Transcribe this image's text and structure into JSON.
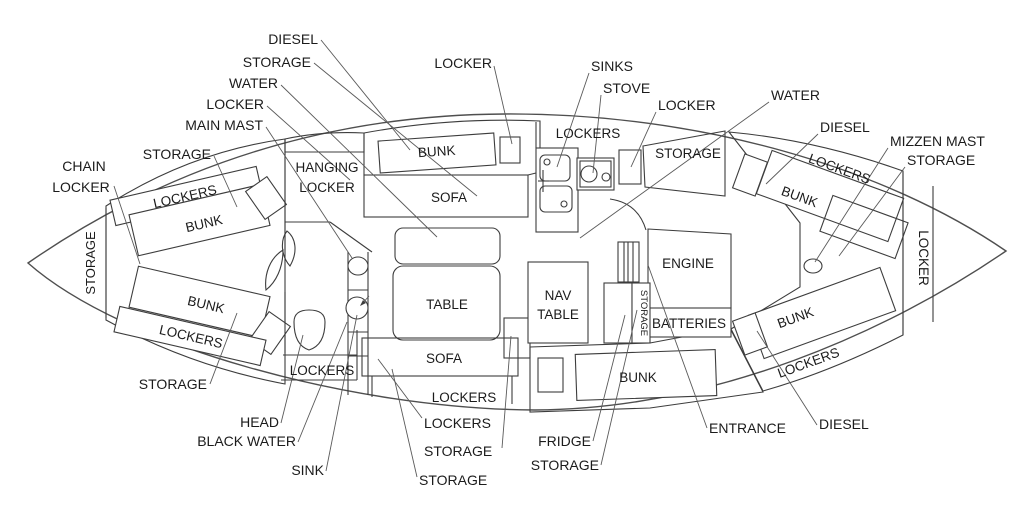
{
  "diagram_type": "sailboat-interior-floor-plan",
  "colors": {
    "background": "#ffffff",
    "wall_line": "#3d3d3d",
    "hull_line": "#4f4f4f",
    "leader_line": "#5a5a5a",
    "hatch_line": "#c4c4c4",
    "crosshatch_line": "#bdbdbd",
    "label_text": "#1b1b1b"
  },
  "external_labels": [
    {
      "id": "label-diesel-port-fwd",
      "anchor": "end",
      "lines": [
        {
          "t": "DIESEL",
          "x": 318,
          "y": 44
        }
      ],
      "leader": [
        [
          321,
          40
        ],
        [
          410,
          150
        ]
      ]
    },
    {
      "id": "label-storage-port-fwd",
      "anchor": "end",
      "lines": [
        {
          "t": "STORAGE",
          "x": 311,
          "y": 67
        }
      ],
      "leader": [
        [
          314,
          63
        ],
        [
          477,
          196
        ]
      ]
    },
    {
      "id": "label-water-port-fwd",
      "anchor": "end",
      "lines": [
        {
          "t": "WATER",
          "x": 278,
          "y": 88
        }
      ],
      "leader": [
        [
          281,
          85
        ],
        [
          437,
          237
        ]
      ]
    },
    {
      "id": "label-locker-port-fwd",
      "anchor": "end",
      "lines": [
        {
          "t": "LOCKER",
          "x": 264,
          "y": 109
        }
      ],
      "leader": [
        [
          267,
          106
        ],
        [
          350,
          180
        ]
      ]
    },
    {
      "id": "label-main-mast",
      "anchor": "end",
      "lines": [
        {
          "t": "MAIN MAST",
          "x": 263,
          "y": 130
        }
      ],
      "leader": [
        [
          266,
          127
        ],
        [
          352,
          258
        ]
      ]
    },
    {
      "id": "label-chain-locker",
      "anchor": "middle",
      "lines": [
        {
          "t": "CHAIN",
          "x": 84,
          "y": 171
        },
        {
          "t": "LOCKER",
          "x": 81,
          "y": 192
        }
      ],
      "leader": [
        [
          114,
          186
        ],
        [
          140,
          264
        ]
      ]
    },
    {
      "id": "label-storage-bow-top",
      "anchor": "end",
      "lines": [
        {
          "t": "STORAGE",
          "x": 211,
          "y": 159
        }
      ],
      "leader": [
        [
          214,
          156
        ],
        [
          237,
          207
        ]
      ]
    },
    {
      "id": "label-locker-top-center",
      "anchor": "end",
      "lines": [
        {
          "t": "LOCKER",
          "x": 492,
          "y": 68
        }
      ],
      "leader": [
        [
          494,
          66
        ],
        [
          512,
          144
        ]
      ]
    },
    {
      "id": "label-sinks",
      "anchor": "start",
      "lines": [
        {
          "t": "SINKS",
          "x": 591,
          "y": 71
        }
      ],
      "leader": [
        [
          589,
          73
        ],
        [
          557,
          167
        ]
      ]
    },
    {
      "id": "label-stove",
      "anchor": "start",
      "lines": [
        {
          "t": "STOVE",
          "x": 603,
          "y": 93
        }
      ],
      "leader": [
        [
          601,
          95
        ],
        [
          593,
          173
        ]
      ]
    },
    {
      "id": "label-locker-galley",
      "anchor": "start",
      "lines": [
        {
          "t": "LOCKER",
          "x": 658,
          "y": 110
        }
      ],
      "leader": [
        [
          656,
          112
        ],
        [
          631,
          167
        ]
      ]
    },
    {
      "id": "label-water-stbd",
      "anchor": "start",
      "lines": [
        {
          "t": "WATER",
          "x": 771,
          "y": 100
        }
      ],
      "leader": [
        [
          769,
          102
        ],
        [
          580,
          238
        ]
      ]
    },
    {
      "id": "label-diesel-aft-port",
      "anchor": "start",
      "lines": [
        {
          "t": "DIESEL",
          "x": 820,
          "y": 132
        }
      ],
      "leader": [
        [
          818,
          134
        ],
        [
          766,
          184
        ]
      ]
    },
    {
      "id": "label-mizzen-mast",
      "anchor": "start",
      "lines": [
        {
          "t": "MIZZEN MAST",
          "x": 890,
          "y": 146
        }
      ],
      "leader": [
        [
          888,
          148
        ],
        [
          815,
          262
        ]
      ]
    },
    {
      "id": "label-storage-stern",
      "anchor": "start",
      "lines": [
        {
          "t": "STORAGE",
          "x": 907,
          "y": 165
        }
      ],
      "leader": [
        [
          905,
          167
        ],
        [
          839,
          256
        ]
      ]
    },
    {
      "id": "label-storage-bow-bottom",
      "anchor": "end",
      "lines": [
        {
          "t": "STORAGE",
          "x": 207,
          "y": 389
        }
      ],
      "leader": [
        [
          210,
          384
        ],
        [
          237,
          313
        ]
      ]
    },
    {
      "id": "label-head",
      "anchor": "end",
      "lines": [
        {
          "t": "HEAD",
          "x": 279,
          "y": 427
        }
      ],
      "leader": [
        [
          281,
          423
        ],
        [
          303,
          335
        ]
      ]
    },
    {
      "id": "label-black-water",
      "anchor": "end",
      "lines": [
        {
          "t": "BLACK WATER",
          "x": 296,
          "y": 446
        }
      ],
      "leader": [
        [
          298,
          442
        ],
        [
          347,
          322
        ]
      ]
    },
    {
      "id": "label-sink",
      "anchor": "end",
      "lines": [
        {
          "t": "SINK",
          "x": 324,
          "y": 475
        }
      ],
      "leader": [
        [
          326,
          471
        ],
        [
          357,
          315
        ]
      ]
    },
    {
      "id": "label-lockers-salon",
      "anchor": "start",
      "lines": [
        {
          "t": "LOCKERS",
          "x": 424,
          "y": 428
        }
      ],
      "leader": [
        [
          422,
          418
        ],
        [
          378,
          359
        ]
      ]
    },
    {
      "id": "label-storage-salon-1",
      "anchor": "start",
      "lines": [
        {
          "t": "STORAGE",
          "x": 424,
          "y": 456
        }
      ],
      "leader": [
        [
          502,
          448
        ],
        [
          511,
          336
        ]
      ]
    },
    {
      "id": "label-storage-salon-2",
      "anchor": "start",
      "lines": [
        {
          "t": "STORAGE",
          "x": 419,
          "y": 485
        }
      ],
      "leader": [
        [
          417,
          477
        ],
        [
          392,
          369
        ]
      ]
    },
    {
      "id": "label-fridge",
      "anchor": "end",
      "lines": [
        {
          "t": "FRIDGE",
          "x": 591,
          "y": 446
        }
      ],
      "leader": [
        [
          593,
          441
        ],
        [
          625,
          315
        ]
      ]
    },
    {
      "id": "label-storage-fridge",
      "anchor": "end",
      "lines": [
        {
          "t": "STORAGE",
          "x": 599,
          "y": 470
        }
      ],
      "leader": [
        [
          601,
          465
        ],
        [
          637,
          310
        ]
      ]
    },
    {
      "id": "label-entrance",
      "anchor": "start",
      "lines": [
        {
          "t": "ENTRANCE",
          "x": 709,
          "y": 433
        }
      ],
      "leader": [
        [
          707,
          428
        ],
        [
          648,
          265
        ]
      ]
    },
    {
      "id": "label-diesel-aft-stbd",
      "anchor": "start",
      "lines": [
        {
          "t": "DIESEL",
          "x": 819,
          "y": 429
        }
      ],
      "leader": [
        [
          817,
          425
        ],
        [
          757,
          331
        ]
      ]
    }
  ],
  "internal_labels": [
    {
      "id": "text-storage-bow",
      "t": "STORAGE",
      "x": 95,
      "y": 263,
      "r": -90,
      "fs": 13
    },
    {
      "id": "text-lockers-vberth-top",
      "t": "LOCKERS",
      "x": 186,
      "y": 201,
      "r": -13
    },
    {
      "id": "text-bunk-vberth-top",
      "t": "BUNK",
      "x": 205,
      "y": 228,
      "r": -13
    },
    {
      "id": "text-bunk-vberth-bottom",
      "t": "BUNK",
      "x": 205,
      "y": 309,
      "r": 13
    },
    {
      "id": "text-lockers-vberth-bottom",
      "t": "LOCKERS",
      "x": 190,
      "y": 341,
      "r": 13
    },
    {
      "id": "text-hanging-1",
      "t": "HANGING",
      "x": 327,
      "y": 172,
      "r": 0
    },
    {
      "id": "text-hanging-2",
      "t": "LOCKER",
      "x": 327,
      "y": 192,
      "r": 0
    },
    {
      "id": "text-bunk-pilot",
      "t": "BUNK",
      "x": 437,
      "y": 156,
      "r": -4
    },
    {
      "id": "text-sofa-top",
      "t": "SOFA",
      "x": 449,
      "y": 202,
      "r": 0
    },
    {
      "id": "text-table",
      "t": "TABLE",
      "x": 447,
      "y": 309,
      "r": 0
    },
    {
      "id": "text-sofa-bottom",
      "t": "SOFA",
      "x": 444,
      "y": 363,
      "r": 0
    },
    {
      "id": "text-lockers-salon-strip",
      "t": "LOCKERS",
      "x": 464,
      "y": 402,
      "r": 0
    },
    {
      "id": "text-lockers-head",
      "t": "LOCKERS",
      "x": 322,
      "y": 375,
      "r": 0
    },
    {
      "id": "text-lockers-galley",
      "t": "LOCKERS",
      "x": 588,
      "y": 138,
      "r": 0
    },
    {
      "id": "text-storage-galley",
      "t": "STORAGE",
      "x": 688,
      "y": 158,
      "r": 0
    },
    {
      "id": "text-nav-1",
      "t": "NAV",
      "x": 558,
      "y": 300,
      "r": 0
    },
    {
      "id": "text-nav-2",
      "t": "TABLE",
      "x": 558,
      "y": 319,
      "r": 0
    },
    {
      "id": "text-engine",
      "t": "ENGINE",
      "x": 688,
      "y": 268,
      "r": 0
    },
    {
      "id": "text-batteries",
      "t": "BATTERIES",
      "x": 689,
      "y": 328,
      "r": 0
    },
    {
      "id": "text-storage-strip",
      "t": "STORAGE",
      "x": 641,
      "y": 313,
      "r": 90,
      "fs": 9.5
    },
    {
      "id": "text-bunk-quarter",
      "t": "BUNK",
      "x": 638,
      "y": 382,
      "r": 0
    },
    {
      "id": "text-bunk-aft-port",
      "t": "BUNK",
      "x": 798,
      "y": 201,
      "r": 20
    },
    {
      "id": "text-lockers-aft-port",
      "t": "LOCKERS",
      "x": 838,
      "y": 173,
      "r": 20
    },
    {
      "id": "text-bunk-aft-stbd",
      "t": "BUNK",
      "x": 797,
      "y": 322,
      "r": -20
    },
    {
      "id": "text-lockers-aft-stbd",
      "t": "LOCKERS",
      "x": 810,
      "y": 367,
      "r": -20
    },
    {
      "id": "text-locker-stern",
      "t": "LOCKER",
      "x": 919,
      "y": 258,
      "r": 90,
      "fs": 13.5
    }
  ]
}
